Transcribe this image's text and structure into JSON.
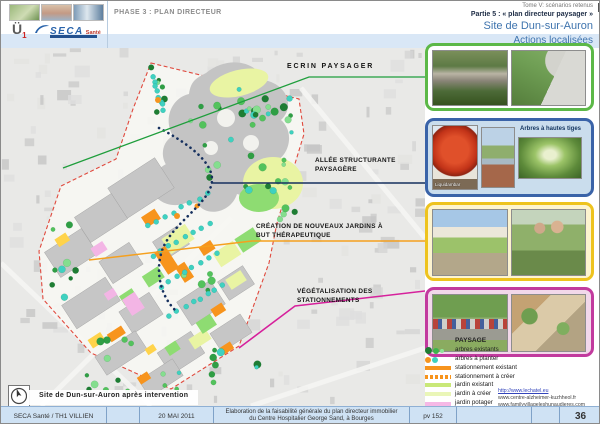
{
  "header": {
    "phase": "PHASE 3 : PLAN DIRECTEUR",
    "tome": "Tome V: scénarios retenus",
    "partie": "Partie 5 : « plan directeur paysager »",
    "site": "Site de Dun-sur-Auron",
    "actions": "Actions localisées"
  },
  "logo": {
    "mark": "Ü",
    "mark_sub": "1",
    "brand": "SECA",
    "suffix": "Santé"
  },
  "map": {
    "labels": {
      "ecrin": "ECRIN PAYSAGER",
      "allee": "ALLÉE STRUCTURANTE PAYSAGÈRE",
      "jardins": "CRÉATION DE NOUVEAUX JARDINS À BUT THÉRAPEUTIQUE",
      "vegetalisation": "VÉGÉTALISATION DES STATIONNEMENTS"
    },
    "caption": "Site de Dun-sur-Auron après intervention"
  },
  "panels": {
    "arbres_label": "Arbres à hautes tiges",
    "liquidambar_caption": "Liquidambar"
  },
  "legend": {
    "title": "PAYSAGE",
    "items": [
      {
        "label": "arbres existants"
      },
      {
        "label": "arbres à planter"
      },
      {
        "label": "stationnement existant"
      },
      {
        "label": "stationnement à créer"
      },
      {
        "label": "jardin existant"
      },
      {
        "label": "jardin à créer"
      },
      {
        "label": "jardin potager",
        "label2": "et agriculture urbaine"
      }
    ],
    "links": [
      "http://www.lechatel.eu",
      "www.centre-alzheimer-kuzhheol.fr",
      "www.familyvillageleshunaudieres.com"
    ]
  },
  "footer": {
    "author": "SECA Santé  / TH1 VILLIEN",
    "date": "20 MAI 2011",
    "description_line1": "Elaboration de la faisabilité générale du plan directeur immobilier",
    "description_line2": "du Centre Hospitalier George Sand, à Bourges",
    "ref": "pv 152",
    "page": "36"
  }
}
